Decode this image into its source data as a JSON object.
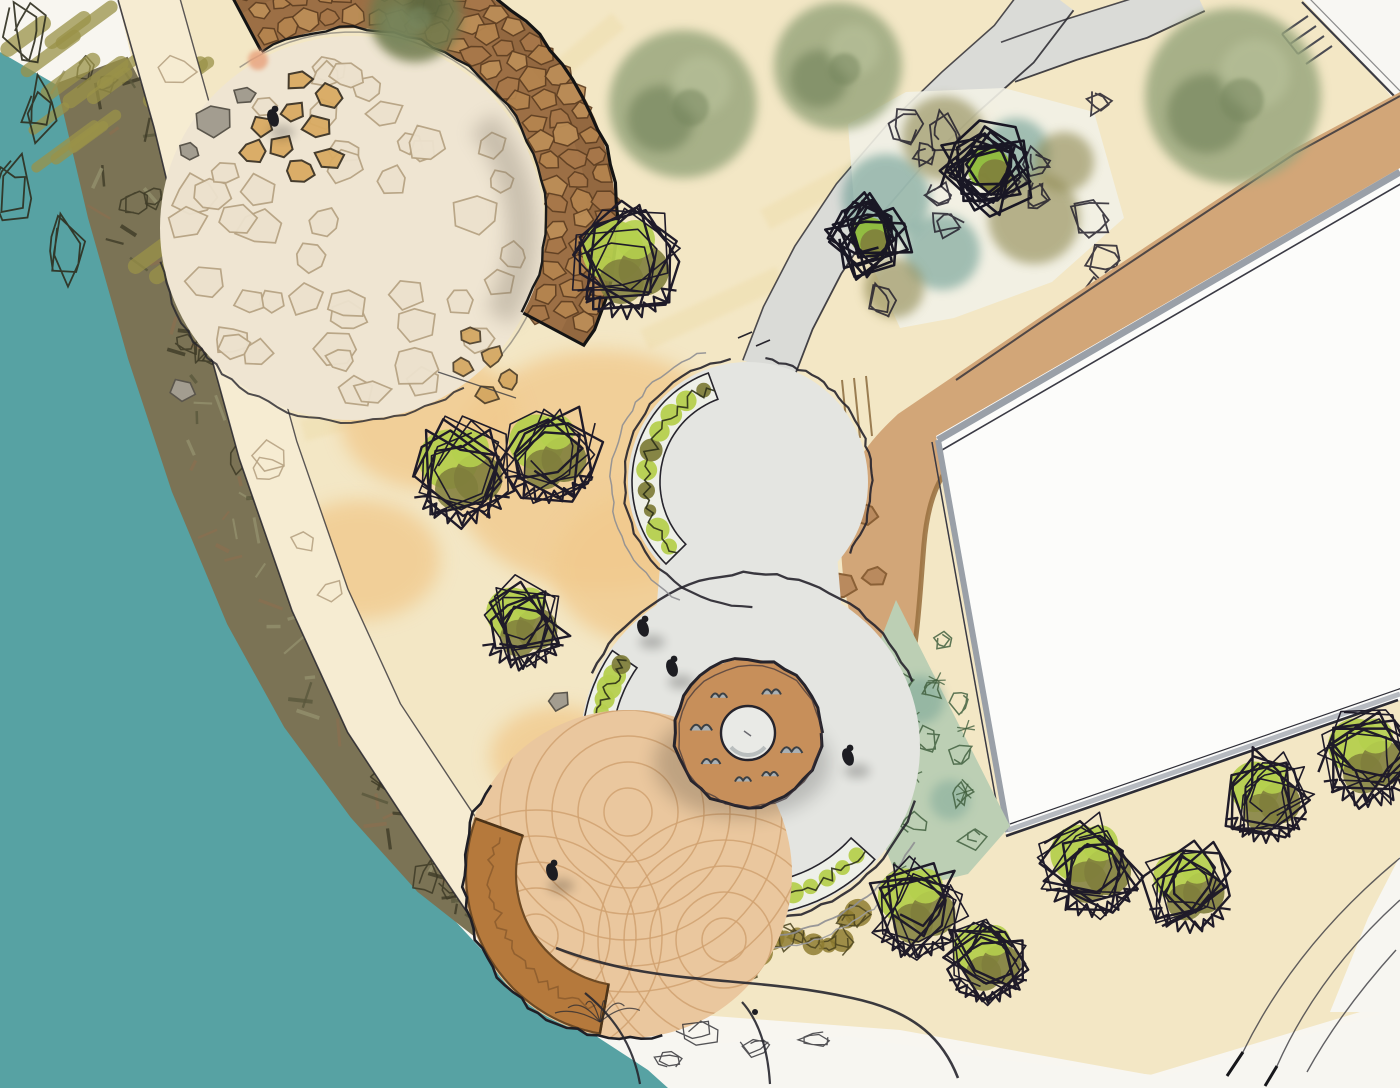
{
  "meta": {
    "width": 1400,
    "height": 1088,
    "description": "Hand-drawn watercolor landscape site plan: waterfront park with circular plaza, donut fountain, stone seat wall amphitheater, timber deck and building"
  },
  "palette": {
    "paper": "#f8f6f0",
    "cream": "#f3e7c5",
    "cream_streak": "#ecd9a2",
    "sand": "#f1ca8e",
    "water": "#57a2a3",
    "veg_base": "#7b7355",
    "veg_dark": "#3e3b27",
    "veg_brown": "#8a6f50",
    "path_cream": "#f6ecd2",
    "ink": "#26242c",
    "stone_joint": "#b7a383",
    "flag_fill": "#efe5d2",
    "wall_brown": "#9c6f45",
    "wall_stone_fill": "#b5854f",
    "wall_stone_line": "#5f3f22",
    "gray_path": "#dadbd7",
    "plaza_gray": "#e4e5e1",
    "plaza_ring": "#5b5864",
    "walkway_tan": "#d2a678",
    "walkway_line": "#9b7342",
    "building_white": "#fcfcfa",
    "building_shadow": "#9aa0a8",
    "sage": "#bccfb4",
    "sage_dark": "#42603f",
    "teal_wash": "#5f948a",
    "olive_wash": "#8d8750",
    "hedge_olive": "#8e7c31",
    "leaf_bright": "#b5cf4e",
    "leaf_olive": "#7f7e3c",
    "tree_soft": "#9aa77e",
    "tree_soft_dark": "#77875e",
    "deck_fill": "#eac79e",
    "deck_line": "#d0a170",
    "bench": "#b5793c",
    "bench_line": "#6e4a24",
    "donut": "#c78f5a",
    "hole": "#e9eae6",
    "bird": "#a9b0b4",
    "people": "#1d1d22",
    "boulder_gray": "#a39d90",
    "boulder_tan": "#d9ab63",
    "pink": "#e8a17b"
  },
  "water": {
    "points": [
      0,
      52,
      62,
      88,
      118,
      205,
      163,
      325,
      205,
      455,
      252,
      585,
      303,
      705,
      357,
      800,
      417,
      880,
      482,
      950,
      543,
      1000,
      602,
      1040,
      648,
      1070,
      668,
      1088,
      0,
      1088
    ]
  },
  "ground": {
    "cream": [
      118,
      0,
      1316,
      0,
      1400,
      108,
      1400,
      1000,
      1150,
      1075,
      900,
      1030,
      700,
      1015,
      560,
      950,
      470,
      860,
      360,
      700,
      262,
      500,
      188,
      280,
      140,
      95
    ],
    "white_bottom": [
      520,
      1088,
      588,
      1018,
      700,
      1044,
      848,
      1036,
      1002,
      1060,
      1164,
      1076,
      1400,
      1008,
      1400,
      1088
    ],
    "white_fan": [
      1400,
      856,
      1400,
      1012,
      1330,
      1012,
      1368,
      918
    ],
    "white_corner": [
      1303,
      0,
      1400,
      0,
      1400,
      102
    ],
    "sand_blobs": [
      [
        600,
        470,
        150,
        120
      ],
      [
        662,
        568,
        110,
        80
      ],
      [
        360,
        560,
        80,
        60
      ],
      [
        560,
        756,
        70,
        50
      ],
      [
        430,
        420,
        90,
        70
      ]
    ],
    "streaks": [
      [
        260,
        120,
        140,
        26,
        -35
      ],
      [
        420,
        210,
        160,
        24,
        -30
      ],
      [
        640,
        330,
        150,
        22,
        -25
      ],
      [
        520,
        90,
        120,
        20,
        -40
      ],
      [
        760,
        210,
        140,
        22,
        -28
      ],
      [
        300,
        420,
        120,
        22,
        -15
      ],
      [
        880,
        170,
        130,
        20,
        -30
      ]
    ]
  },
  "shore_vegetation": {
    "centerline": [
      92,
      70,
      140,
      200,
      185,
      340,
      230,
      470,
      282,
      600,
      332,
      700,
      390,
      790,
      448,
      866,
      495,
      915
    ],
    "halfwidth": [
      38,
      55,
      60,
      62,
      60,
      55,
      48,
      40,
      30
    ]
  },
  "corner_grass": {
    "box": [
      6,
      6,
      170,
      320
    ]
  },
  "shore_path": {
    "centerline": [
      147,
      -8,
      183,
      120,
      224,
      290,
      268,
      450,
      320,
      600,
      374,
      718,
      428,
      800,
      468,
      860,
      505,
      915,
      540,
      952
    ],
    "halfwidth": 30
  },
  "court": {
    "cx": 352,
    "cy": 228,
    "r": 192,
    "cells": 46
  },
  "wall": {
    "cx": 352,
    "cy": 222,
    "r0": 194,
    "r1": 264,
    "a0": -118,
    "a1": 28,
    "rows": [
      206,
      231,
      254
    ],
    "end_stones": [
      [
        300,
        80
      ],
      [
        330,
        96
      ],
      [
        292,
        112
      ],
      [
        262,
        126
      ],
      [
        318,
        128
      ],
      [
        282,
        148
      ],
      [
        252,
        152
      ],
      [
        330,
        158
      ],
      [
        300,
        170
      ]
    ],
    "spill_stones": [
      [
        470,
        336
      ],
      [
        492,
        356
      ],
      [
        508,
        380
      ],
      [
        462,
        366
      ],
      [
        486,
        394
      ]
    ]
  },
  "rocks": [
    [
      183,
      390,
      15
    ],
    [
      558,
      700,
      13
    ],
    [
      212,
      120,
      20
    ],
    [
      246,
      95,
      13
    ],
    [
      190,
      151,
      11
    ]
  ],
  "pink_mark": [
    258,
    60
  ],
  "north_path": {
    "centerline": [
      768,
      370,
      788,
      318,
      818,
      260,
      858,
      200,
      906,
      144,
      960,
      92,
      1014,
      44,
      1052,
      -6
    ],
    "halfwidth": 27,
    "prong": [
      1008,
      62,
      1070,
      40,
      1140,
      18,
      1196,
      -8
    ],
    "prong_halfwidth": 21
  },
  "top_bed": {
    "polygon": [
      848,
      124,
      906,
      92,
      1004,
      88,
      1094,
      112,
      1124,
      218,
      1052,
      282,
      954,
      318,
      900,
      328,
      856,
      230
    ],
    "teal": [
      [
        886,
        198,
        44
      ],
      [
        942,
        252,
        38
      ],
      [
        1016,
        152,
        34
      ]
    ],
    "olive": [
      [
        944,
        138,
        42
      ],
      [
        1034,
        218,
        46
      ],
      [
        894,
        288,
        30
      ],
      [
        1064,
        162,
        30
      ]
    ],
    "dark_shrubs": [
      [
        869,
        236,
        42
      ],
      [
        989,
        168,
        48
      ]
    ]
  },
  "boundary": {
    "line": [
      1302,
      2,
      1398,
      100
    ],
    "marks": [
      [
        1282,
        34,
        1308,
        16
      ],
      [
        1290,
        44,
        1316,
        26
      ],
      [
        1298,
        54,
        1324,
        36
      ],
      [
        1306,
        64,
        1332,
        46
      ],
      [
        1282,
        34,
        1298,
        54
      ]
    ]
  },
  "walkway": {
    "outline": "M1400,92 L1292,150 L1162,236 L1042,316 L954,376 L898,414 C866,444 846,470 842,516 C838,572 848,628 872,668 L906,690 C918,646 920,590 924,544 C928,498 940,470 966,450 C994,428 1050,400 1106,368 L1228,292 L1336,224 L1400,186 Z",
    "curb": "M906,690 C918,646 920,590 924,544 C928,498 940,470 966,450 C994,428 1050,400 1106,368 L1340,222",
    "outer_ink": "M1400,96 L1294,154 L1164,240 L1044,320 L956,380",
    "step_lines": [
      [
        842,
        380,
        848,
        440
      ],
      [
        854,
        378,
        860,
        438
      ],
      [
        866,
        376,
        872,
        436
      ]
    ],
    "boulders": [
      [
        820,
        528,
        17
      ],
      [
        864,
        514,
        15
      ],
      [
        840,
        586,
        16
      ],
      [
        874,
        576,
        14
      ]
    ]
  },
  "building": {
    "polygon": [
      936,
      436,
      1400,
      168,
      1400,
      700,
      1006,
      834
    ],
    "top_edge": [
      938,
      440,
      1400,
      172
    ],
    "left_edge": [
      938,
      440,
      1008,
      832
    ],
    "bottom_edge": [
      1008,
      830,
      1400,
      694
    ]
  },
  "sage_bed": {
    "polygon": [
      896,
      600,
      1010,
      826,
      968,
      874,
      902,
      890,
      866,
      800,
      858,
      698
    ]
  },
  "plaza": {
    "lower": [
      750,
      747,
      170
    ],
    "upper": [
      748,
      482,
      120
    ],
    "neck": [
      664,
      520,
      834,
      520,
      846,
      660,
      652,
      660
    ],
    "bands": [
      [
        748,
        482,
        88,
        116,
        135,
        250
      ],
      [
        750,
        747,
        138,
        168,
        167,
        215
      ],
      [
        750,
        747,
        136,
        168,
        42,
        112
      ]
    ],
    "hedge": [
      750,
      747,
      205,
      55,
      116
    ],
    "arcs": [
      [
        750,
        747,
        174,
        18,
        150,
        "ink",
        2.4
      ],
      [
        750,
        747,
        174,
        205,
        338,
        "ink",
        2.4
      ],
      [
        750,
        747,
        190,
        30,
        118,
        "#8e8e92",
        1.8
      ],
      [
        750,
        747,
        203,
        44,
        106,
        "#9b9b9f",
        1.4
      ],
      [
        748,
        482,
        124,
        88,
        262,
        "ink",
        2.2
      ],
      [
        748,
        482,
        124,
        -82,
        35,
        "ink",
        2.2
      ],
      [
        748,
        482,
        137,
        120,
        252,
        "#8e8e92",
        1.5
      ]
    ],
    "ticks": [
      [
        738,
        338,
        752,
        332
      ],
      [
        756,
        346,
        770,
        340
      ]
    ]
  },
  "fountain": {
    "c": [
      748,
      733
    ],
    "r_outer": 74,
    "r_hole": 27,
    "bird_angles": [
      96,
      142,
      186,
      232,
      300,
      22,
      62
    ],
    "bird_r": 47
  },
  "deck": {
    "c": [
      628,
      874
    ],
    "r": 164,
    "families": [
      [
        628,
        812,
        24,
        184,
        26
      ],
      [
        536,
        936,
        22,
        150,
        26
      ],
      [
        724,
        940,
        22,
        140,
        26
      ]
    ],
    "bench": {
      "r0": 112,
      "r1": 162,
      "a0": 100,
      "a1": 200
    }
  },
  "shrubs": [
    [
      462,
      470,
      54
    ],
    [
      549,
      452,
      50
    ],
    [
      523,
      622,
      46
    ],
    [
      627,
      262,
      56
    ],
    [
      918,
      906,
      50
    ],
    [
      988,
      958,
      44
    ],
    [
      1092,
      864,
      52
    ],
    [
      1190,
      886,
      46
    ],
    [
      1266,
      796,
      46
    ],
    [
      1368,
      756,
      50
    ]
  ],
  "soft_trees": [
    [
      683,
      104,
      74,
      "light"
    ],
    [
      838,
      66,
      64,
      "light"
    ],
    [
      1233,
      96,
      88,
      "light"
    ],
    [
      415,
      16,
      46,
      "dark"
    ]
  ],
  "people": [
    [
      273,
      118
    ],
    [
      643,
      628
    ],
    [
      672,
      668
    ],
    [
      848,
      757
    ],
    [
      552,
      872
    ]
  ],
  "sketch": {
    "fan": [
      "M1400,858 Q1296,944 1243,1052",
      "M1400,900 Q1318,974 1277,1066",
      "M1396,950 Q1340,1012 1307,1072"
    ],
    "fan_ticks": [
      "M1243,1052 l-16,24",
      "M1277,1066 l-12,20"
    ],
    "bottom_edges": [
      "M556,948 C660,988 744,974 852,998 C918,1012 944,1042 958,1078",
      "M585,993 C618,1020 634,1050 640,1084",
      "M742,1002 C760,1022 768,1052 770,1084"
    ],
    "grass_loops": [
      [
        700,
        1032,
        16
      ],
      [
        756,
        1046,
        14
      ],
      [
        816,
        1038,
        12
      ],
      [
        668,
        1060,
        10
      ]
    ],
    "grass_rays": [
      600,
      1022
    ],
    "arrow": [
      438,
      372,
      516,
      398
    ]
  }
}
